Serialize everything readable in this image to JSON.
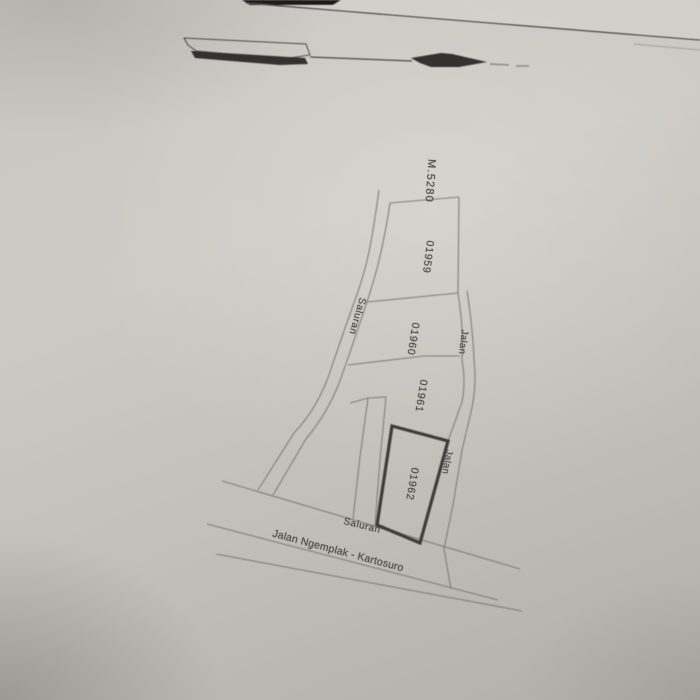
{
  "map": {
    "survey_mark_label": "M.5280",
    "parcels": [
      {
        "number": "01959",
        "bold_outline": false
      },
      {
        "number": "01960",
        "bold_outline": false
      },
      {
        "number": "01961",
        "bold_outline": false
      },
      {
        "number": "01962",
        "bold_outline": true
      }
    ],
    "feature_labels": {
      "channel_upper": "Saluran",
      "channel_lower": "Saluran",
      "road_upper": "Jalan",
      "road_lower": "Jalan",
      "main_road": "Jalan Ngemplak - Kartosuro"
    }
  },
  "colors": {
    "paper": "#c6c4be",
    "paper_light": "#d2d0c9",
    "paper_dark": "#b0ada6",
    "thin_line": "#7d7a74",
    "bold_line": "#3d3b38",
    "ink_black": "#33312e",
    "text": "#514f4b",
    "photo_edge_dark": "#1c1b1a"
  }
}
